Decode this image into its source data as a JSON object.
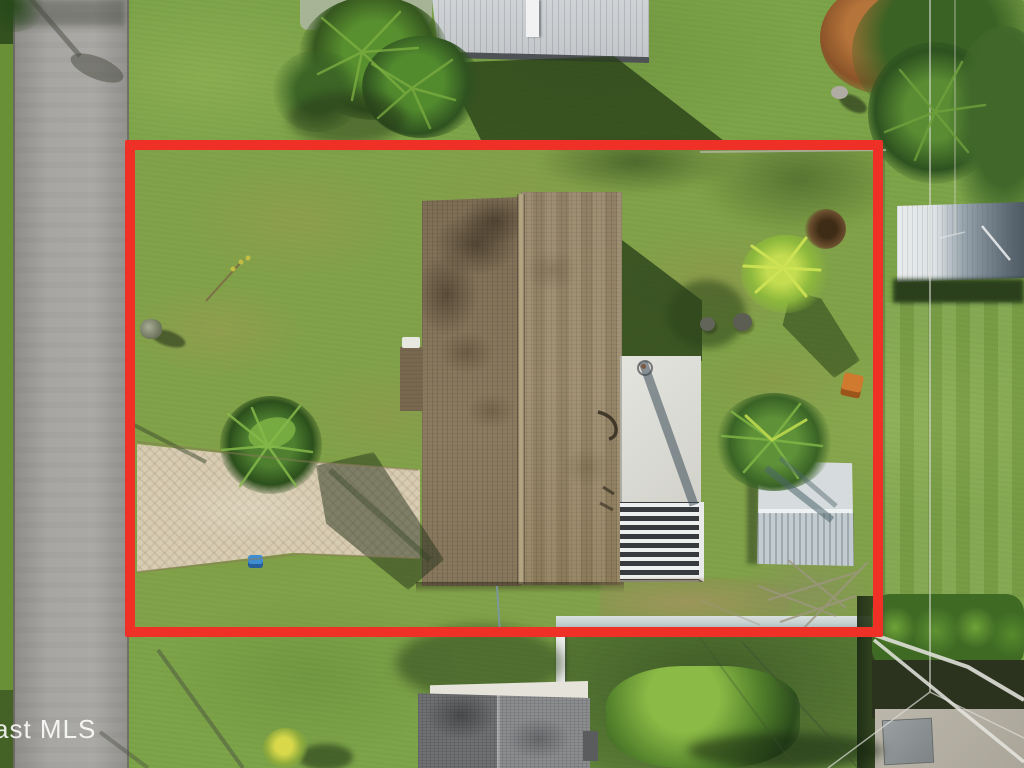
{
  "meta": {
    "type": "aerial-property-photo",
    "description": "Overhead drone view of a single-family home lot outlined with a red property-boundary rectangle, street on the left, neighboring houses top and bottom, shed and pergola in backyard"
  },
  "watermark": {
    "text": "ast MLS"
  },
  "annotation": {
    "label": "property-boundary",
    "shape": "rectangle"
  },
  "colors": {
    "grassBase": "#7da449",
    "boundaryRed": "#ee3026",
    "road": "#a3a29e",
    "roofLeft": "#7d6e55",
    "roofRight": "#98876a",
    "driveway": "#d8ccb2",
    "patio": "#dcdcd6",
    "shed": "#ced5d8",
    "neighborRoofTop": "#c9cdd0",
    "neighborRoofRight": "#dde2e4",
    "bottomNeighborRoof": "#7d7f82"
  }
}
